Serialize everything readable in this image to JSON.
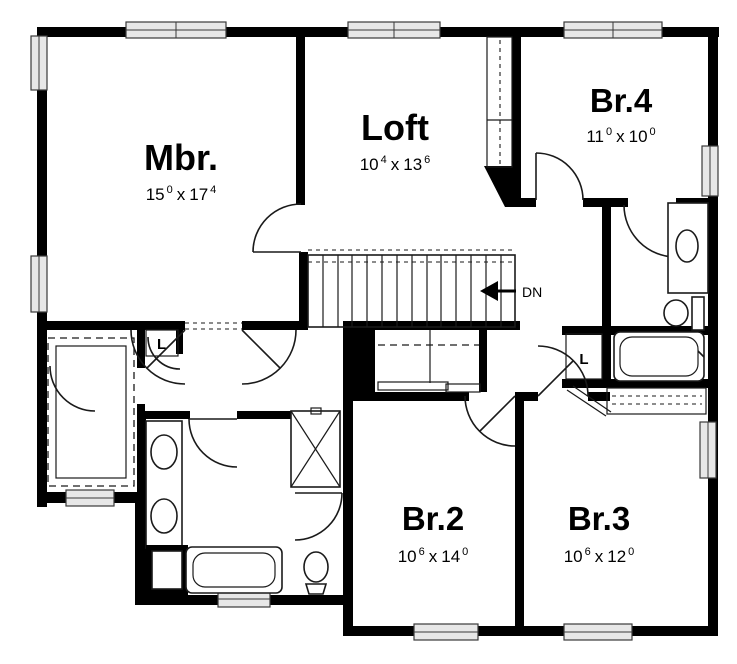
{
  "plan": {
    "type": "floor-plan",
    "floor": "second floor",
    "dim_separator": "x",
    "rooms": [
      {
        "id": "mbr",
        "label": "Mbr.",
        "dim": {
          "w": "15",
          "wi": "0",
          "h": "17",
          "hi": "4"
        }
      },
      {
        "id": "loft",
        "label": "Loft",
        "dim": {
          "w": "10",
          "wi": "4",
          "h": "13",
          "hi": "6"
        }
      },
      {
        "id": "br4",
        "label": "Br.4",
        "dim": {
          "w": "11",
          "wi": "0",
          "h": "10",
          "hi": "0"
        }
      },
      {
        "id": "br2",
        "label": "Br.2",
        "dim": {
          "w": "10",
          "wi": "6",
          "h": "14",
          "hi": "0"
        }
      },
      {
        "id": "br3",
        "label": "Br.3",
        "dim": {
          "w": "10",
          "wi": "6",
          "h": "12",
          "hi": "0"
        }
      }
    ],
    "annotations": {
      "down_label": "DN",
      "linen_left": "L",
      "linen_right": "L"
    },
    "colors": {
      "wall": "#000000",
      "background": "#ffffff",
      "window_fill": "#e7e7e7",
      "line": "#1a1a1a"
    }
  }
}
